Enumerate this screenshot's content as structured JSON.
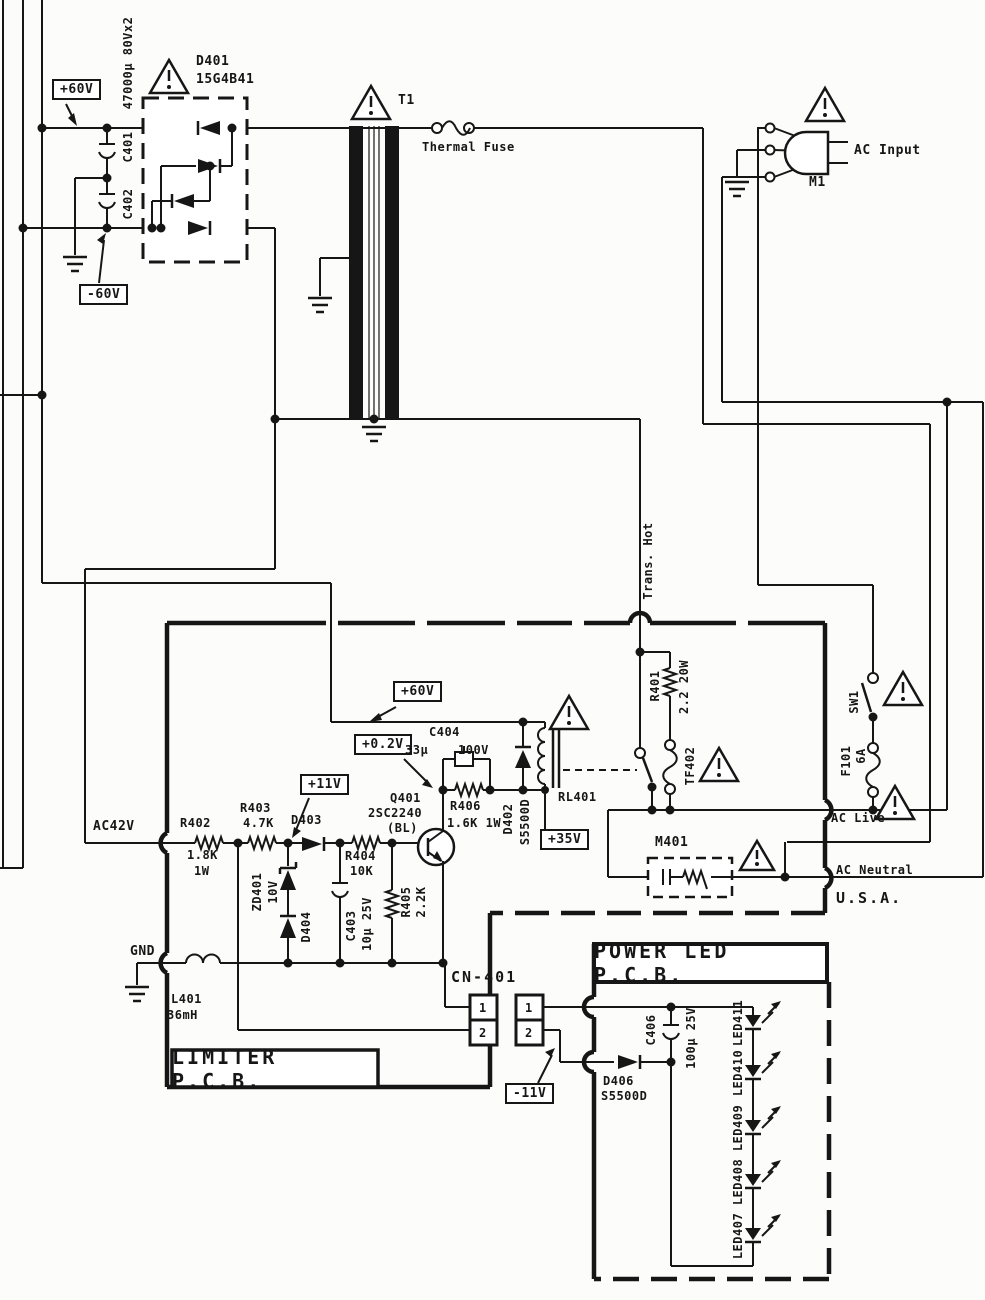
{
  "colors": {
    "ink": "#161616",
    "paper": "#fcfcfa"
  },
  "pcbs": {
    "limiter_title": "LIMITER P.C.B.",
    "power_led_title": "POWER LED P.C.B."
  },
  "connector": {
    "name": "CN-401",
    "pin1": "1",
    "pin2": "2"
  },
  "labels": {
    "v_plus60": "+60V",
    "v_minus60": "-60V",
    "v_plus02": "+0.2V",
    "v_plus11": "+11V",
    "v_plus35": "+35V",
    "v_minus11": "-11V",
    "ac42": "AC42V",
    "gnd": "GND",
    "trans_hot": "Trans. Hot",
    "ac_live": "AC Live",
    "ac_neutral": "AC Neutral",
    "usa": "U.S.A.",
    "ac_input": "AC Input",
    "thermal_fuse": "Thermal Fuse",
    "c401": "C401",
    "c401_val": "47000µ 80Vx2",
    "c402": "C402",
    "d401": "D401",
    "d401_val": "15G4B41",
    "t1": "T1",
    "m1": "M1",
    "r401": "R401",
    "r401_val": "2.2 20W",
    "tf402": "TF402",
    "sw1": "SW1",
    "f101": "F101",
    "f101_val": "6A",
    "m401": "M401",
    "rl401": "RL401",
    "d402": "D402",
    "d402_val": "S5500D",
    "c404": "C404",
    "c404_v1": "33µ",
    "c404_v2": "100V",
    "r406": "R406",
    "r406_val": "1.6K 1W",
    "q401": "Q401",
    "q401_part": "2SC2240",
    "q401_grade": "(BL)",
    "r402": "R402",
    "r402_v1": "1.8K",
    "r402_v2": "1W",
    "r403": "R403",
    "r403_val": "4.7K",
    "d403": "D403",
    "zd401": "ZD401",
    "zd401_val": "10V",
    "d404": "D404",
    "c403": "C403",
    "c403_val": "10µ 25V",
    "r404": "R404",
    "r404_val": "10K",
    "r405": "R405",
    "r405_val": "2.2K",
    "l401": "L401",
    "l401_val": "36mH",
    "d406": "D406",
    "d406_val": "S5500D",
    "c406": "C406",
    "c406_val": "100µ 25V",
    "led407": "LED407",
    "led408": "LED408",
    "led409": "LED409",
    "led410": "LED410",
    "led411": "LED411"
  }
}
